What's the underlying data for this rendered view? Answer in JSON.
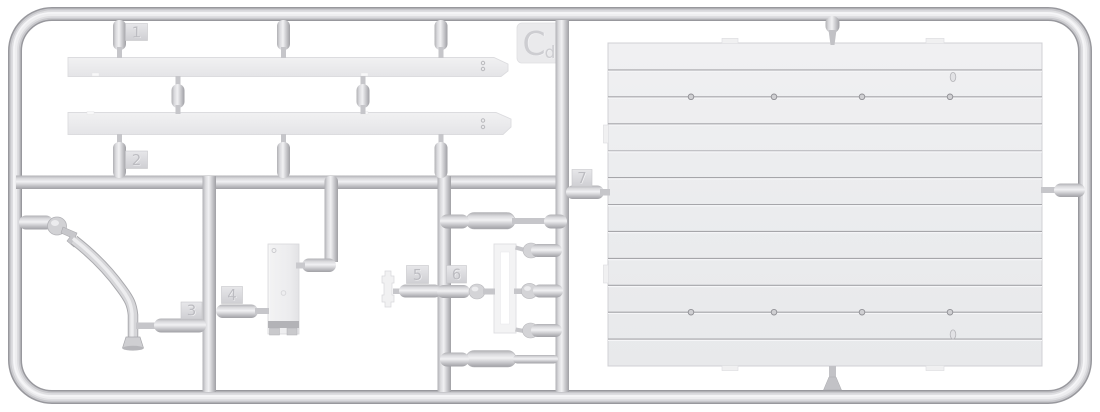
{
  "sprue": {
    "code_tag": {
      "main": "C",
      "sub": "d"
    },
    "part_tags": [
      {
        "label": "1"
      },
      {
        "label": "2"
      },
      {
        "label": "3"
      },
      {
        "label": "4"
      },
      {
        "label": "5"
      },
      {
        "label": "6"
      },
      {
        "label": "7"
      }
    ],
    "colors": {
      "background": "#ffffff",
      "plastic_mid": "#d6d6d9",
      "plastic_highlight": "#f1f1f3",
      "plastic_shadow": "#9e9ea3",
      "part_surface": "#ededef",
      "panel_surface": "#ebecee",
      "plank_groove": "#a4a4a8"
    }
  }
}
